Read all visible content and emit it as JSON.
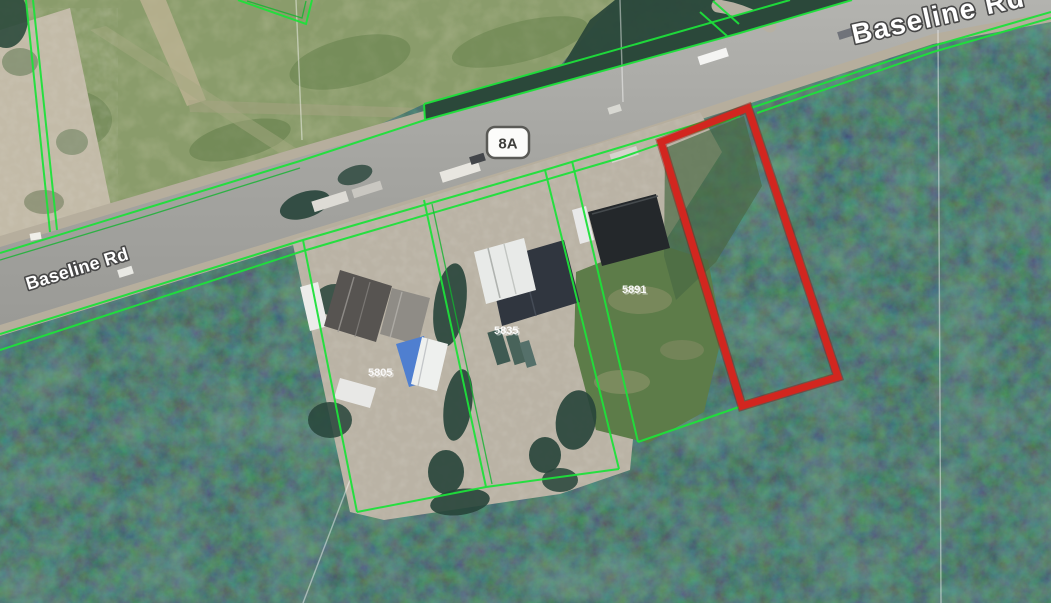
{
  "map_view": {
    "road_name_left": "Baseline Rd",
    "road_name_top_right": "Baseline Rd",
    "highway_shield_label": "8A",
    "address_labels": {
      "left": "5805",
      "middle": "5835",
      "right": "5891"
    },
    "colors": {
      "parcel_line_green": "#1ee03a",
      "parcel_line_green_dark": "#12b42e",
      "subject_parcel_red": "#d2261f",
      "forest_base": "#223b32",
      "field_base": "#8a9c6b",
      "road_surface": "#a9a9a5",
      "road_shoulder": "#b6ae9d",
      "gravel_lot": "#bab3a5",
      "survey_line_white": "#ffffff"
    }
  }
}
